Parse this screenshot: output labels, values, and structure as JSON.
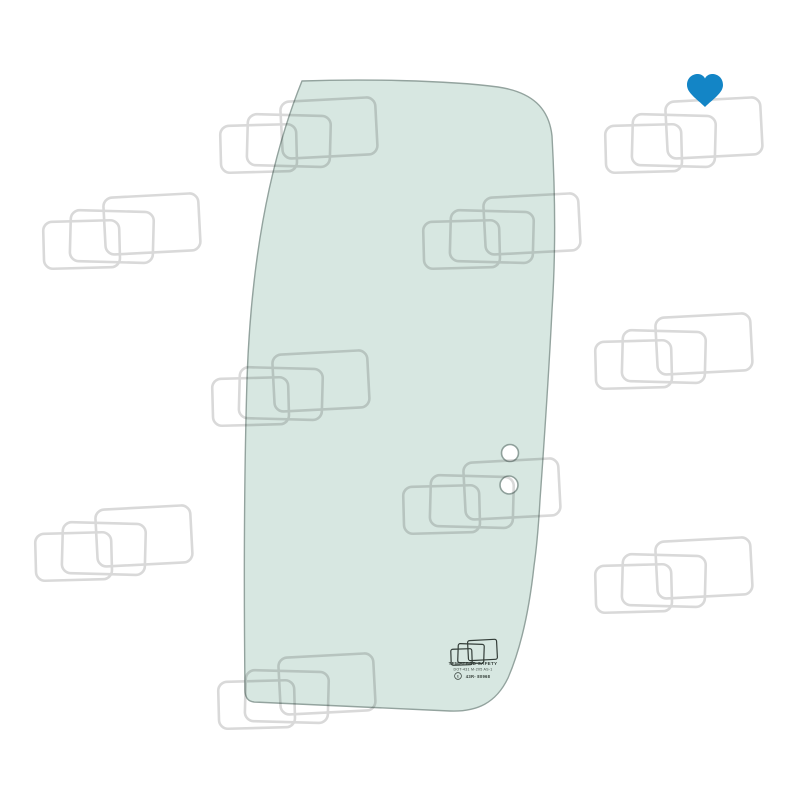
{
  "canvas": {
    "width": 800,
    "height": 800,
    "background": "#ffffff"
  },
  "wishlist": {
    "icon": "heart-icon",
    "color": "#1385c6"
  },
  "watermark": {
    "icon": "overlapping-rectangles-pattern",
    "line_color": "#d9d9d9",
    "cluster_count": 10
  },
  "glass": {
    "tint_color": "#d7e7e1",
    "edge_color": "#93a39e",
    "holes": {
      "count": 2,
      "fill": "#ffffff",
      "edge_color": "#8fa09b"
    },
    "stamp": {
      "logo_icon": "overlapping-rectangles-logo",
      "line1": "TEMPERED SAFETY",
      "line2": "DOT-431 M-205 AS-1",
      "line3": "43R- 80968",
      "cert_icon": "e-mark-circle-icon",
      "cert_letter": "E",
      "ink_color": "#333d38"
    }
  }
}
